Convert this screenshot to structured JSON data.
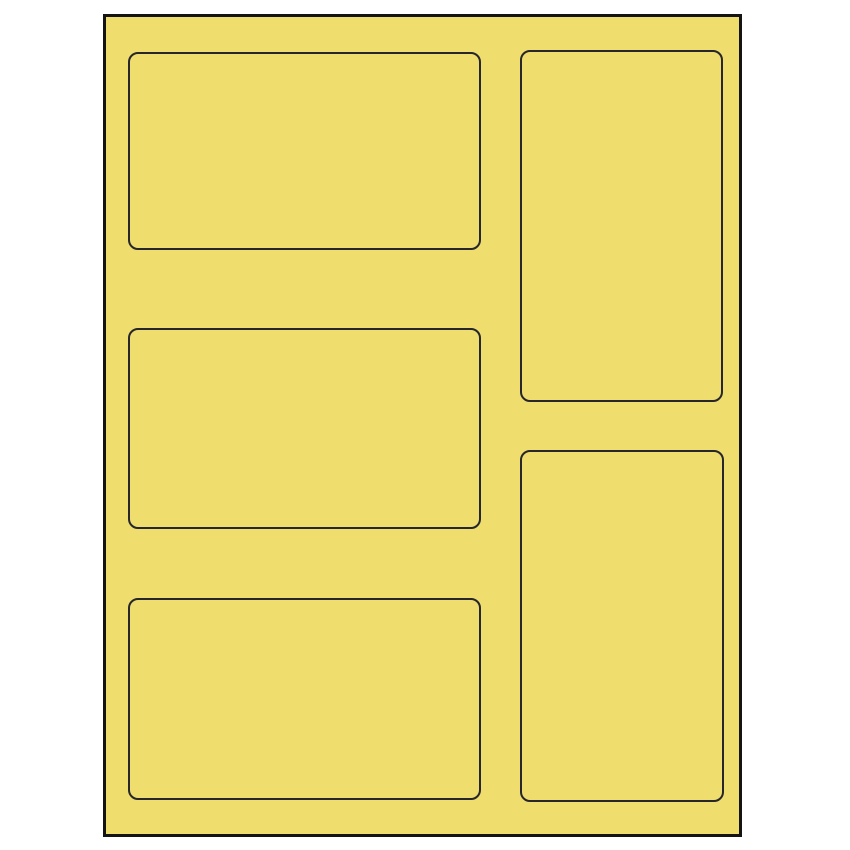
{
  "canvas": {
    "width": 850,
    "height": 850,
    "background_color": "#ffffff"
  },
  "sheet": {
    "description": "blank-label-sheet-template",
    "fill_color": "#efdd6e",
    "border_color": "#141414",
    "x": 103,
    "y": 14,
    "width": 639,
    "height": 823
  },
  "labels": {
    "outline_color": "#26262c",
    "corner_radius": 10,
    "count": 5,
    "slots": [
      {
        "name": "label-slot-left-top",
        "orientation": "landscape",
        "x": 22,
        "y": 35,
        "w": 353,
        "h": 198
      },
      {
        "name": "label-slot-left-middle",
        "orientation": "landscape",
        "x": 22,
        "y": 311,
        "w": 353,
        "h": 201
      },
      {
        "name": "label-slot-left-bottom",
        "orientation": "landscape",
        "x": 22,
        "y": 581,
        "w": 353,
        "h": 202
      },
      {
        "name": "label-slot-right-top",
        "orientation": "portrait",
        "x": 414,
        "y": 33,
        "w": 203,
        "h": 352
      },
      {
        "name": "label-slot-right-bottom",
        "orientation": "portrait",
        "x": 414,
        "y": 433,
        "w": 204,
        "h": 352
      }
    ]
  }
}
